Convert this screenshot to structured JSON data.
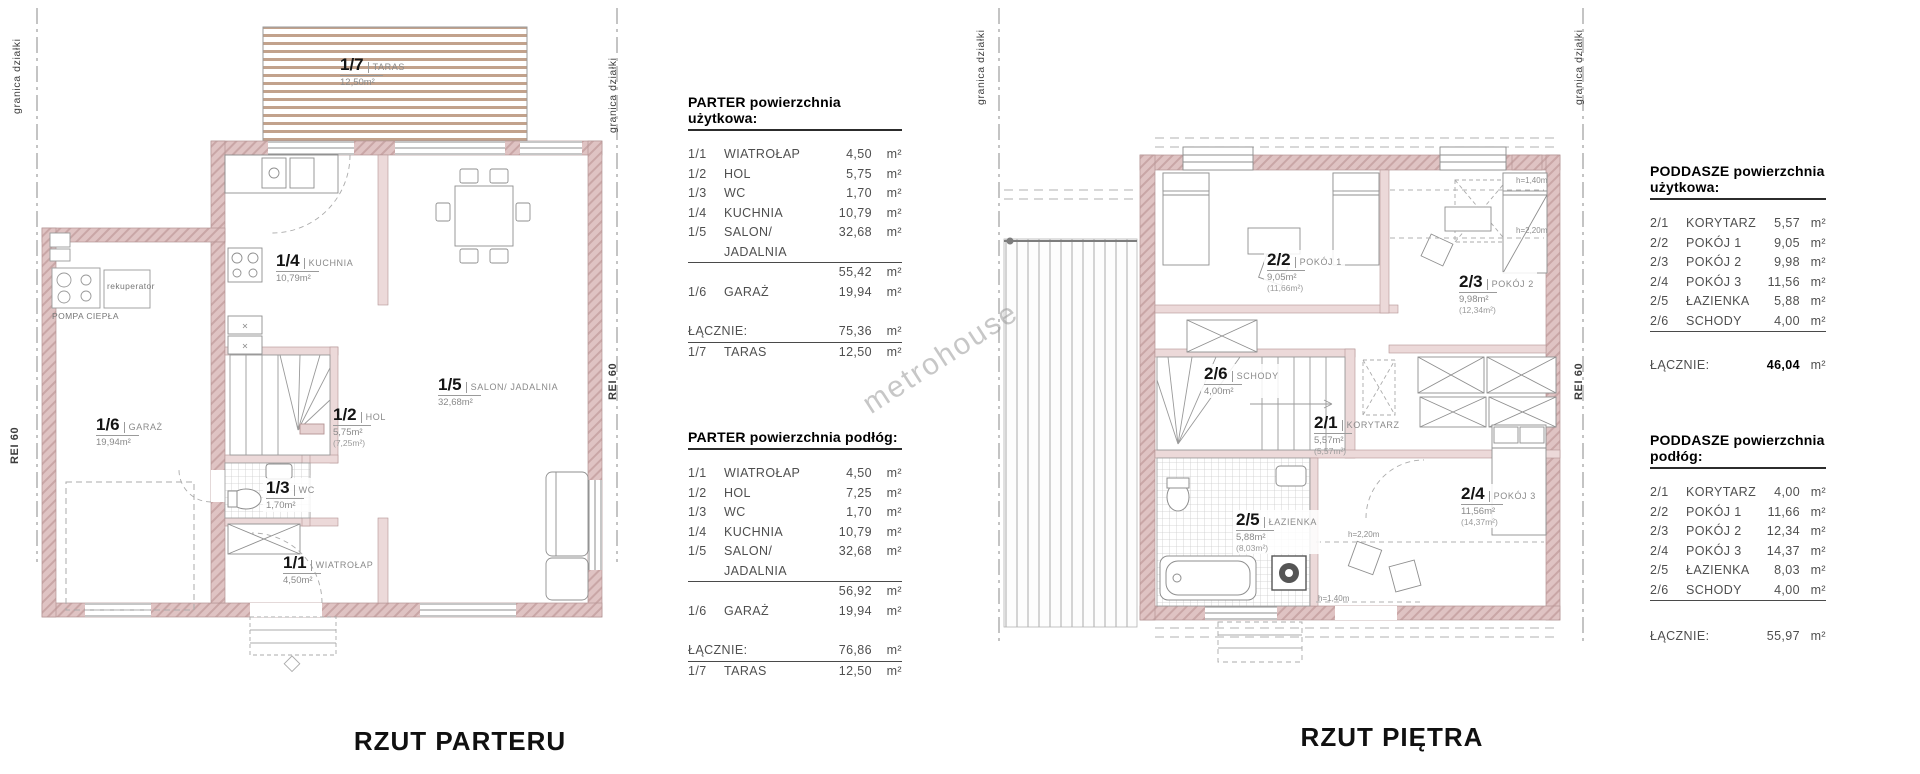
{
  "boundary": {
    "granica": "granica działki",
    "rei": "REI 60"
  },
  "watermark": "metrohouse",
  "parter": {
    "title": "RZUT PARTERU",
    "rooms": [
      {
        "id": "1/7",
        "name": "TARAS",
        "a": "12,50m²"
      },
      {
        "id": "1/4",
        "name": "KUCHNIA",
        "a": "10,79m²"
      },
      {
        "id": "1/5",
        "name": "SALON/ JADALNIA",
        "a": "32,68m²"
      },
      {
        "id": "1/6",
        "name": "GARAŻ",
        "a": "19,94m²"
      },
      {
        "id": "1/2",
        "name": "HOL",
        "a": "5,75m²",
        "a2": "(7,25m²)"
      },
      {
        "id": "1/3",
        "name": "WC",
        "a": "1,70m²"
      },
      {
        "id": "1/1",
        "name": "WIATROŁAP",
        "a": "4,50m²"
      }
    ],
    "notes": {
      "rekuperator": "rekuperator",
      "pompa": "POMPA CIEPŁA"
    }
  },
  "pietro": {
    "title": "RZUT PIĘTRA",
    "rooms": [
      {
        "id": "2/2",
        "name": "POKÓJ 1",
        "a": "9,05m²",
        "a2": "(11,66m²)"
      },
      {
        "id": "2/3",
        "name": "POKÓJ 2",
        "a": "9,98m²",
        "a2": "(12,34m²)"
      },
      {
        "id": "2/6",
        "name": "SCHODY",
        "a": "4,00m²"
      },
      {
        "id": "2/1",
        "name": "KORYTARZ",
        "a": "5,57m²",
        "a2": "(5,57m²)"
      },
      {
        "id": "2/5",
        "name": "ŁAZIENKA",
        "a": "5,88m²",
        "a2": "(8,03m²)"
      },
      {
        "id": "2/4",
        "name": "POKÓJ 3",
        "a": "11,56m²",
        "a2": "(14,37m²)"
      }
    ],
    "notes": {
      "h140a": "h=1,40m",
      "h220a": "h=2,20m",
      "h220b": "h=2,20m",
      "h140b": "h=1,40m"
    }
  },
  "tables": {
    "t1": {
      "title": "PARTER powierzchnia użytkowa:",
      "rows": [
        {
          "id": "1/1",
          "name": "WIATROŁAP",
          "v": "4,50",
          "u": "m²"
        },
        {
          "id": "1/2",
          "name": "HOL",
          "v": "5,75",
          "u": "m²"
        },
        {
          "id": "1/3",
          "name": "WC",
          "v": "1,70",
          "u": "m²"
        },
        {
          "id": "1/4",
          "name": "KUCHNIA",
          "v": "10,79",
          "u": "m²"
        },
        {
          "id": "1/5",
          "name": "SALON/ JADALNIA",
          "v": "32,68",
          "u": "m²"
        },
        {
          "id": "",
          "name": "",
          "v": "55,42",
          "u": "m²"
        },
        {
          "id": "1/6",
          "name": "GARAŻ",
          "v": "19,94",
          "u": "m²"
        }
      ],
      "total": {
        "label": "ŁĄCZNIE:",
        "v": "75,36",
        "u": "m²"
      },
      "after": {
        "id": "1/7",
        "name": "TARAS",
        "v": "12,50",
        "u": "m²"
      }
    },
    "t2": {
      "title": "PARTER powierzchnia podłóg:",
      "rows": [
        {
          "id": "1/1",
          "name": "WIATROŁAP",
          "v": "4,50",
          "u": "m²"
        },
        {
          "id": "1/2",
          "name": "HOL",
          "v": "7,25",
          "u": "m²"
        },
        {
          "id": "1/3",
          "name": "WC",
          "v": "1,70",
          "u": "m²"
        },
        {
          "id": "1/4",
          "name": "KUCHNIA",
          "v": "10,79",
          "u": "m²"
        },
        {
          "id": "1/5",
          "name": "SALON/ JADALNIA",
          "v": "32,68",
          "u": "m²"
        },
        {
          "id": "",
          "name": "",
          "v": "56,92",
          "u": "m²"
        },
        {
          "id": "1/6",
          "name": "GARAŻ",
          "v": "19,94",
          "u": "m²"
        }
      ],
      "total": {
        "label": "ŁĄCZNIE:",
        "v": "76,86",
        "u": "m²"
      },
      "after": {
        "id": "1/7",
        "name": "TARAS",
        "v": "12,50",
        "u": "m²"
      }
    },
    "t3": {
      "title": "PODDASZE powierzchnia użytkowa:",
      "rows": [
        {
          "id": "2/1",
          "name": "KORYTARZ",
          "v": "5,57",
          "u": "m²"
        },
        {
          "id": "2/2",
          "name": "POKÓJ 1",
          "v": "9,05",
          "u": "m²"
        },
        {
          "id": "2/3",
          "name": "POKÓJ 2",
          "v": "9,98",
          "u": "m²"
        },
        {
          "id": "2/4",
          "name": "POKÓJ 3",
          "v": "11,56",
          "u": "m²"
        },
        {
          "id": "2/5",
          "name": "ŁAZIENKA",
          "v": "5,88",
          "u": "m²"
        },
        {
          "id": "2/6",
          "name": "SCHODY",
          "v": "4,00",
          "u": "m²"
        }
      ],
      "total": {
        "label": "ŁĄCZNIE:",
        "v": "46,04",
        "u": "m²"
      }
    },
    "t4": {
      "title": "PODDASZE powierzchnia podłóg:",
      "rows": [
        {
          "id": "2/1",
          "name": "KORYTARZ",
          "v": "4,00",
          "u": "m²"
        },
        {
          "id": "2/2",
          "name": "POKÓJ 1",
          "v": "11,66",
          "u": "m²"
        },
        {
          "id": "2/3",
          "name": "POKÓJ 2",
          "v": "12,34",
          "u": "m²"
        },
        {
          "id": "2/4",
          "name": "POKÓJ 3",
          "v": "14,37",
          "u": "m²"
        },
        {
          "id": "2/5",
          "name": "ŁAZIENKA",
          "v": "8,03",
          "u": "m²"
        },
        {
          "id": "2/6",
          "name": "SCHODY",
          "v": "4,00",
          "u": "m²"
        }
      ],
      "total": {
        "label": "ŁĄCZNIE:",
        "v": "55,97",
        "u": "m²"
      }
    }
  }
}
